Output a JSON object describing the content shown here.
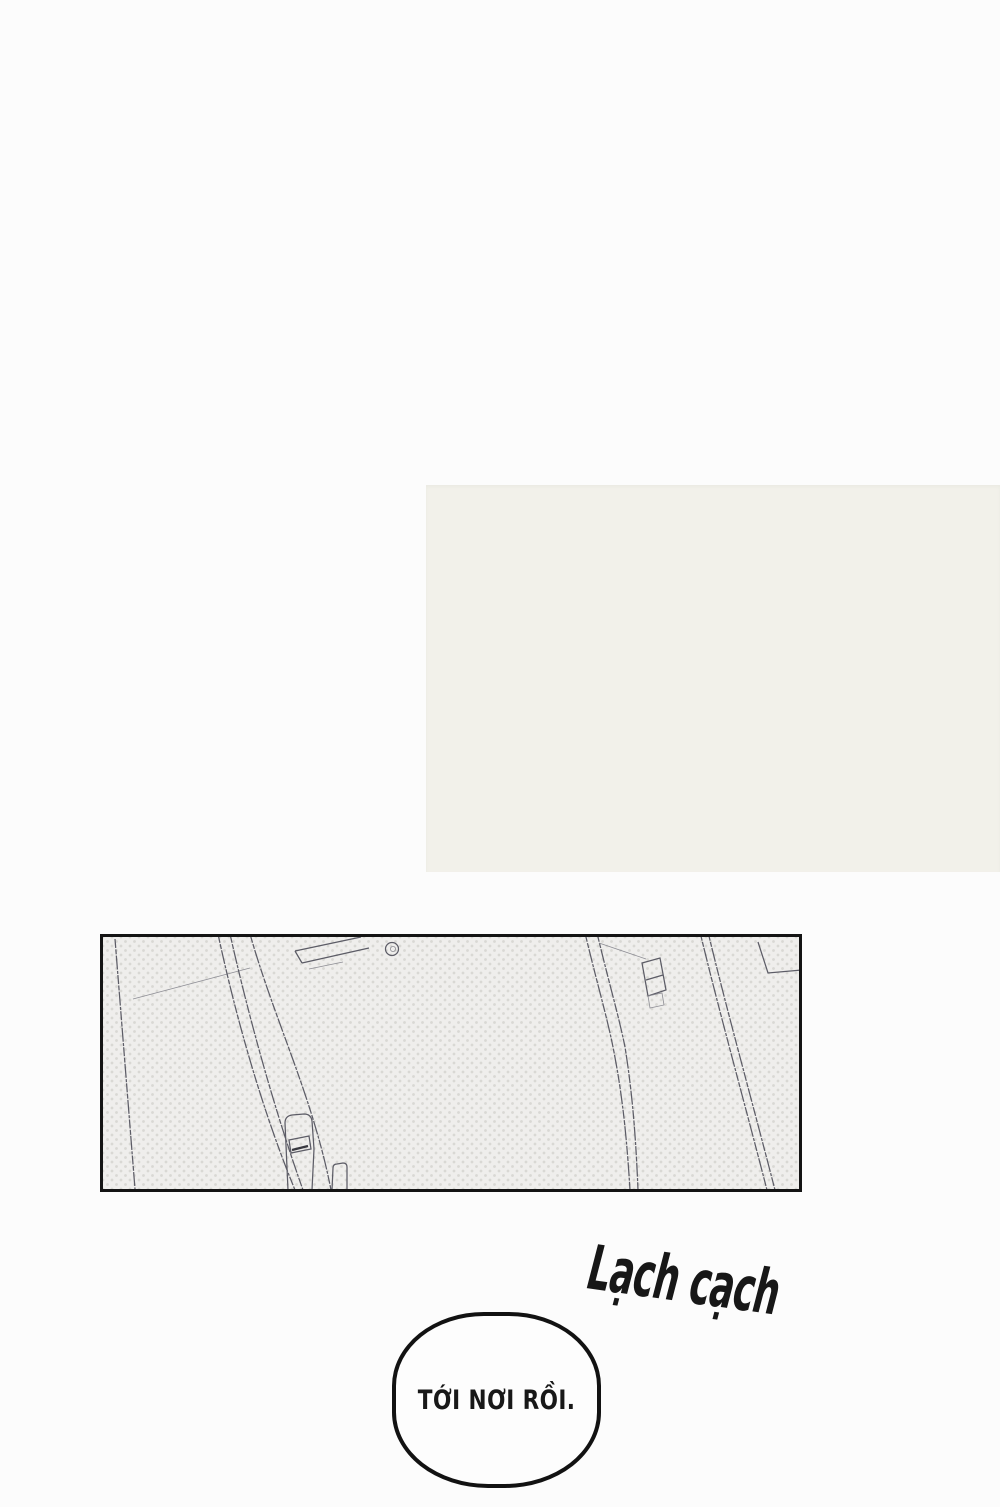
{
  "page": {
    "kind": "comic-page"
  },
  "colors": {
    "page_background": "#fcfcfc",
    "tone_block": "#f2f1ea",
    "panel_fill": "#efeeec",
    "panel_halftone_dot": "#d9d8d4",
    "panel_border": "#141414",
    "ink": "#171717",
    "sketch_line": "#5c5c66"
  },
  "sfx": {
    "text": "Lạch cạch"
  },
  "speech_bubble": {
    "text": "TỚI NƠI RỒI."
  }
}
